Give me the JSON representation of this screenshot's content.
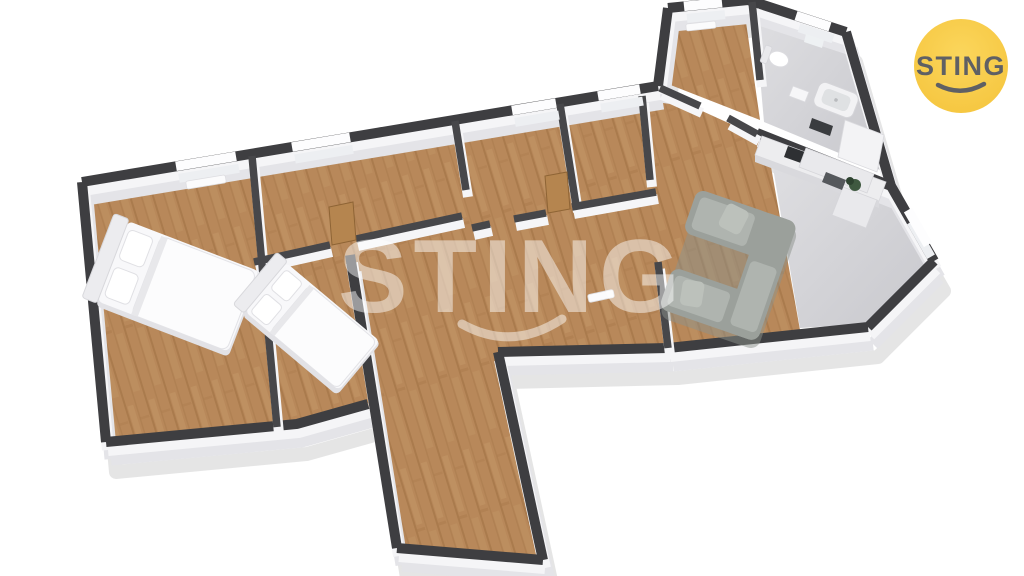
{
  "brand": {
    "logo_text": "STING"
  },
  "watermark": {
    "text": "STING"
  },
  "palette": {
    "background": "#ffffff",
    "wall_cap": "#3E3E41",
    "wall_cap_int": "#47474A",
    "wall_face": "#F5F5F7",
    "wall_face_deep": "#E4E4E8",
    "wood": "#B8885A",
    "wood_stripe": "#A8794B",
    "wood_light": "#C99C6C",
    "tile": "#D3D3D6",
    "sofa": "#9BA09B",
    "sofa_light": "#AFB4AF",
    "sofa_dark": "#8C918B",
    "bed": "#F8F8FA",
    "bed_shade": "#E2E2E6",
    "door": "#B5854F",
    "logo_bg": "#F5C43C",
    "logo_bg_light": "#FBD65C",
    "logo_fg": "#5F6064",
    "watermark": "rgba(255,255,255,0.48)"
  }
}
